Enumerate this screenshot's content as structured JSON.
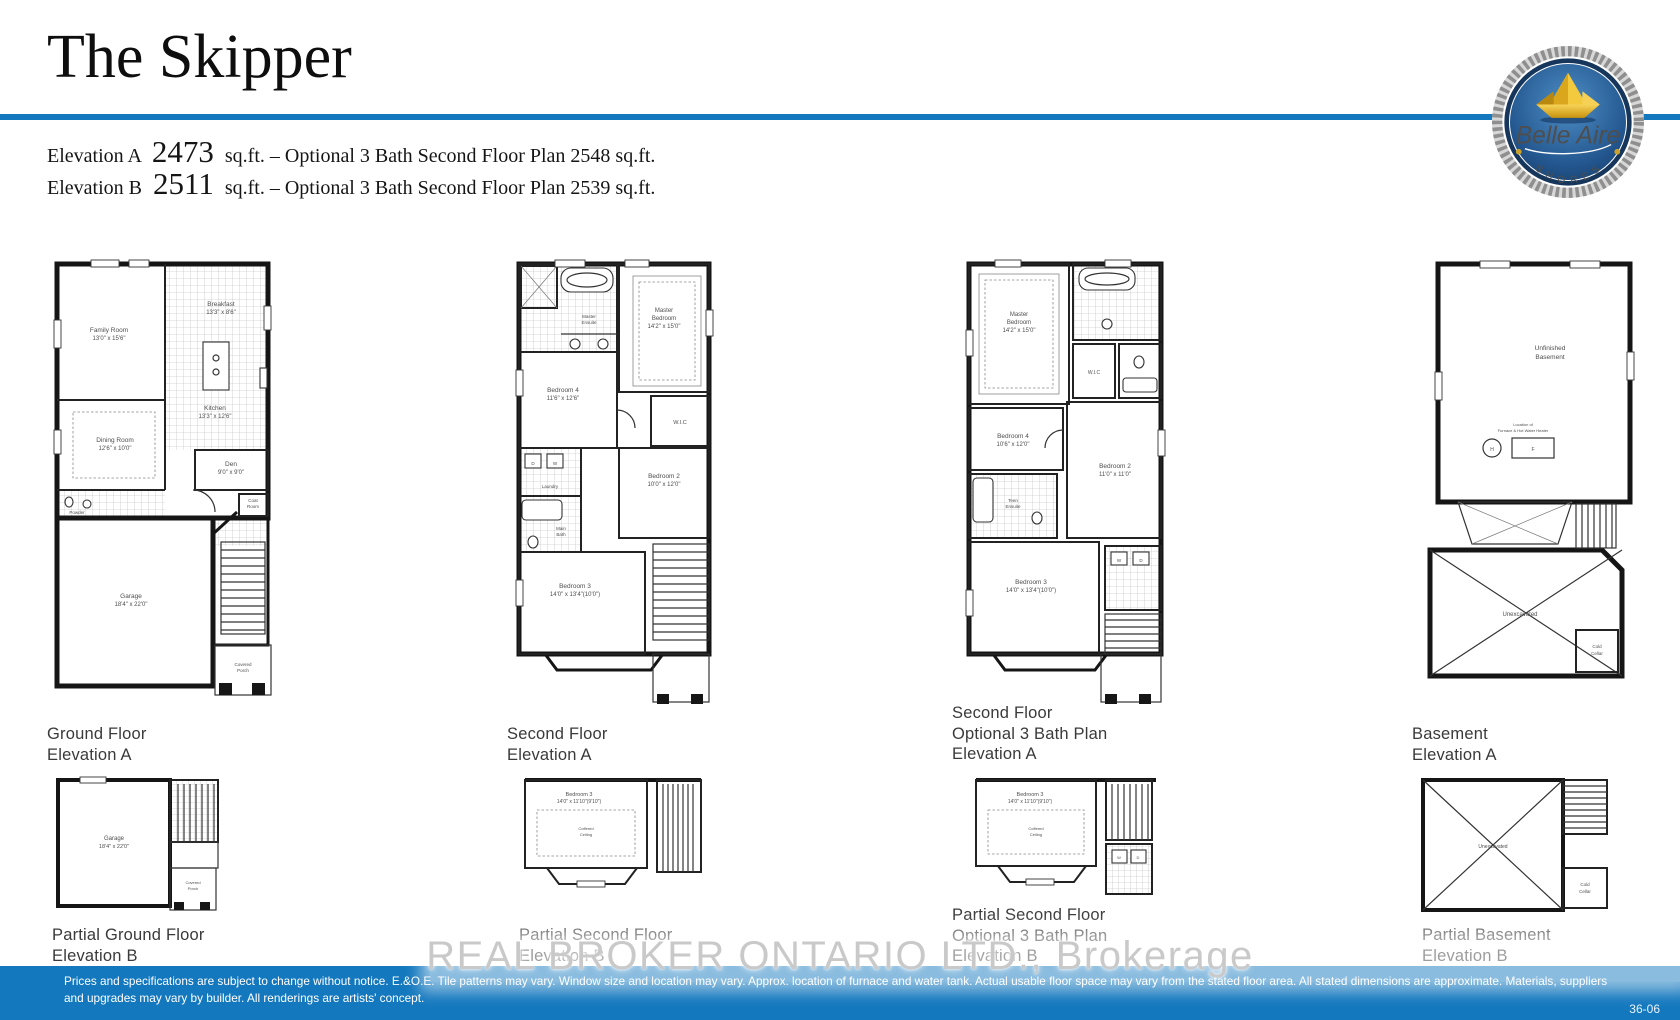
{
  "header": {
    "title": "The Skipper",
    "elevation_a": {
      "label": "Elevation A",
      "sqft": "2473",
      "rest": "sq.ft. – Optional 3 Bath Second Floor Plan 2548 sq.ft."
    },
    "elevation_b": {
      "label": "Elevation B",
      "sqft": "2511",
      "rest": "sq.ft. – Optional 3 Bath Second Floor Plan 2539 sq.ft."
    }
  },
  "logo": {
    "brand": "Belle Aire",
    "sub": "S H O R E S"
  },
  "plans": {
    "ground_a": {
      "caption1": "Ground Floor",
      "caption2": "Elevation A",
      "family1": "Family Room",
      "family2": "13'0\" x 15'6\"",
      "breakfast1": "Breakfast",
      "breakfast2": "13'3\" x 8'6\"",
      "kitchen1": "Kitchen",
      "kitchen2": "13'3\" x 12'6\"",
      "dining1": "Dining Room",
      "dining2": "12'6\" x 10'0\"",
      "den1": "Den",
      "den2": "9'0\" x 9'0\"",
      "garage1": "Garage",
      "garage2": "18'4\" x 22'0\"",
      "powder": "Powder",
      "coat1": "Coat",
      "coat2": "Room",
      "porch1": "Covered",
      "porch2": "Porch"
    },
    "second_a": {
      "caption1": "Second Floor",
      "caption2": "Elevation A",
      "master1": "Master",
      "master2": "Bedroom",
      "master3": "14'2\" x 15'0\"",
      "ensuite1": "Master",
      "ensuite2": "Ensuite",
      "bed4_1": "Bedroom 4",
      "bed4_2": "11'6\" x 12'6\"",
      "bed2_1": "Bedroom 2",
      "bed2_2": "10'0\" x 12'0\"",
      "bed3_1": "Bedroom 3",
      "bed3_2": "14'0\" x 13'4\"(10'0\")",
      "wic": "W.I.C",
      "laundry": "Laundry",
      "bath1": "Main",
      "bath2": "Bath",
      "d": "D",
      "w": "W"
    },
    "second3_a": {
      "caption1": "Second Floor",
      "caption2": "Optional 3 Bath Plan",
      "caption3": "Elevation A",
      "master1": "Master",
      "master2": "Bedroom",
      "master3": "14'2\" x 15'0\"",
      "bed4_1": "Bedroom 4",
      "bed4_2": "10'6\" x 12'0\"",
      "bed2_1": "Bedroom 2",
      "bed2_2": "11'0\" x 11'0\"",
      "bed3_1": "Bedroom 3",
      "bed3_2": "14'0\" x 13'4\"(10'0\")",
      "teen1": "Teen",
      "teen2": "Ensuite",
      "wic": "W.I.C",
      "w": "W",
      "d": "D"
    },
    "basement_a": {
      "caption1": "Basement",
      "caption2": "Elevation A",
      "unf1": "Unfinished",
      "unf2": "Basement",
      "loc1": "Location of",
      "loc2": "Furnace & Hot Water Heater",
      "h": "H",
      "f": "F",
      "unex": "Unexcavated",
      "cold1": "Cold",
      "cold2": "Cellar"
    },
    "ground_b": {
      "caption1": "Partial Ground Floor",
      "caption2": "Elevation B",
      "garage1": "Garage",
      "garage2": "18'4\" x 22'0\"",
      "porch1": "Covered",
      "porch2": "Porch"
    },
    "second_b": {
      "caption1": "Partial Second Floor",
      "caption2": "Elevation B",
      "bed3_1": "Bedroom 3",
      "bed3_2": "14'0\" x 11'10\"(9'10\")",
      "coffered1": "Coffered",
      "coffered2": "Ceiling"
    },
    "second3_b": {
      "caption1": "Partial Second Floor",
      "caption2": "Optional 3 Bath Plan",
      "caption3": "Elevation B",
      "bed3_1": "Bedroom 3",
      "bed3_2": "14'0\" x 11'10\"(9'10\")",
      "coffered1": "Coffered",
      "coffered2": "Ceiling",
      "w": "W",
      "d": "D"
    },
    "basement_b": {
      "caption1": "Partial Basement",
      "caption2": "Elevation B",
      "unex": "Unexcavated",
      "cold1": "Cold",
      "cold2": "Cellar"
    }
  },
  "watermark": "REAL BROKER ONTARIO LTD., Brokerage",
  "footer": {
    "line1": "Prices and specifications are subject to change without notice. E.&O.E. Tile patterns may vary. Window size and location may vary. Approx. location of furnace and water tank. Actual usable floor space may vary from the stated floor area. All stated dimensions are approximate. Materials, suppliers",
    "line2": "and upgrades may vary by builder. All renderings are artists' concept.",
    "page": "36-06"
  },
  "colors": {
    "accent_blue": "#1478be",
    "logo_navy": "#16365c",
    "logo_gold": "#e9b62a"
  }
}
